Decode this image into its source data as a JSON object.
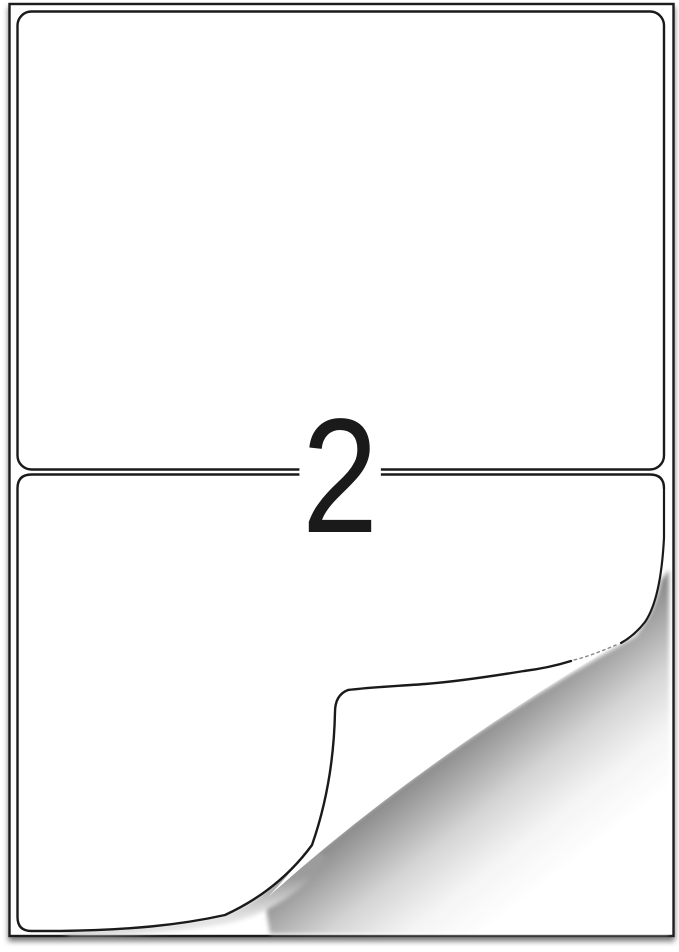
{
  "sheet": {
    "labels_per_sheet_text": "2"
  },
  "colors": {
    "background": "#ffffff",
    "line": "#1a1a1a",
    "fold_shadow_dark": "#8f8f8f",
    "edge_shadow": "#9c9c9c"
  }
}
